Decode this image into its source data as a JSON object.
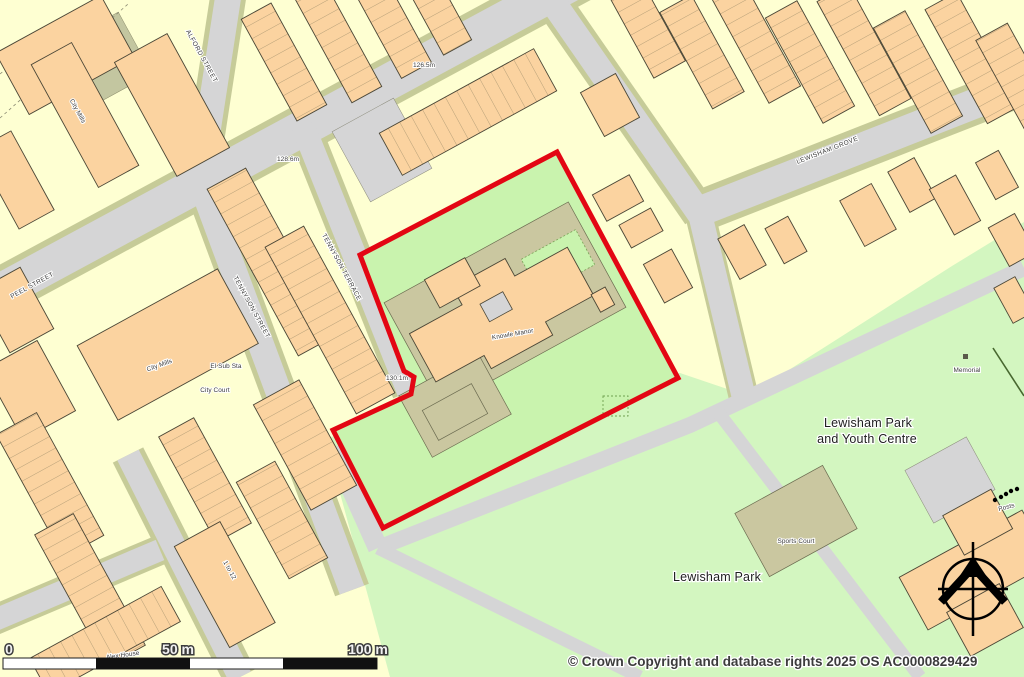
{
  "map": {
    "streets": {
      "alford": "ALFORD STREET",
      "peel": "PEEL STREET",
      "tennyson_street": "TENNYSON STREET",
      "tennyson_terrace": "TENNYSON TERRACE",
      "lewisham_grove": "LEWISHAM GROVE"
    },
    "places": {
      "city_mills": "City Mills",
      "el_sub_sta": "El Sub Sta",
      "city_court": "City Court",
      "knowle_manor": "Knowle Manor",
      "alex_house": "Alex House",
      "one_to_twelve": "1 to 12",
      "youth_centre_line1": "Lewisham Park",
      "youth_centre_line2": "and Youth Centre",
      "lewisham_park": "Lewisham Park",
      "sports_court": "Sports Court",
      "memorial": "Memorial",
      "posts": "Posts"
    },
    "spot_heights": {
      "h1": "128.6m",
      "h2": "126.5m",
      "h3": "130.1m"
    },
    "scale_bar": {
      "zero": "0",
      "fifty": "50 m",
      "hundred": "100 m"
    },
    "copyright": "© Crown Copyright and database rights 2025 OS AC0000829429",
    "colors": {
      "boundary_red": "#e30613",
      "road_grey": "#d5d5d6",
      "verge_olive": "#c6cb98",
      "building_peach": "#fbd3a0",
      "yard_yellow": "#feffd2",
      "park_green": "#d3f6c0",
      "site_green": "#c9f3ae",
      "hardstanding_tan": "#cac7a0"
    }
  }
}
